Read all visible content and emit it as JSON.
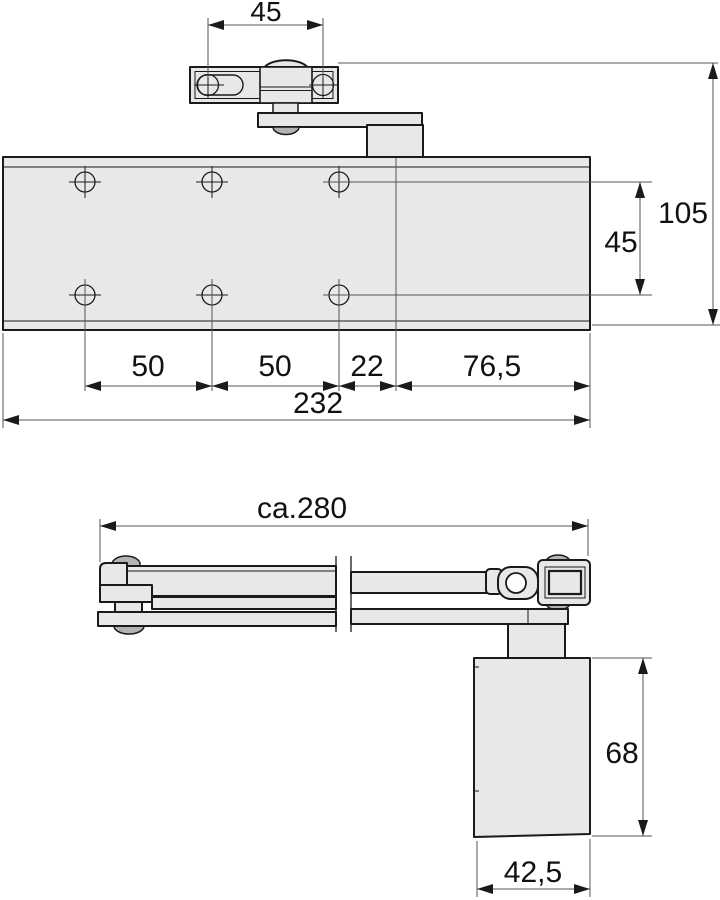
{
  "colors": {
    "outline": "#1a1a1a",
    "fill-light": "#e8e8e8",
    "fill-mid": "#b3b3b3",
    "dimline": "#555555",
    "text": "#111111",
    "bg": "#ffffff"
  },
  "front_view": {
    "dims": {
      "bracket_hole_spacing": "45",
      "overall_height": "105",
      "hole_row_spacing": "45",
      "hole_pitch_left": "50",
      "hole_pitch_right": "50",
      "hole_to_spindle": "22",
      "spindle_to_end": "76,5",
      "overall_length": "232"
    }
  },
  "top_view": {
    "dims": {
      "arm_length": "ca.280",
      "body_depth": "68",
      "body_width": "42,5"
    }
  }
}
